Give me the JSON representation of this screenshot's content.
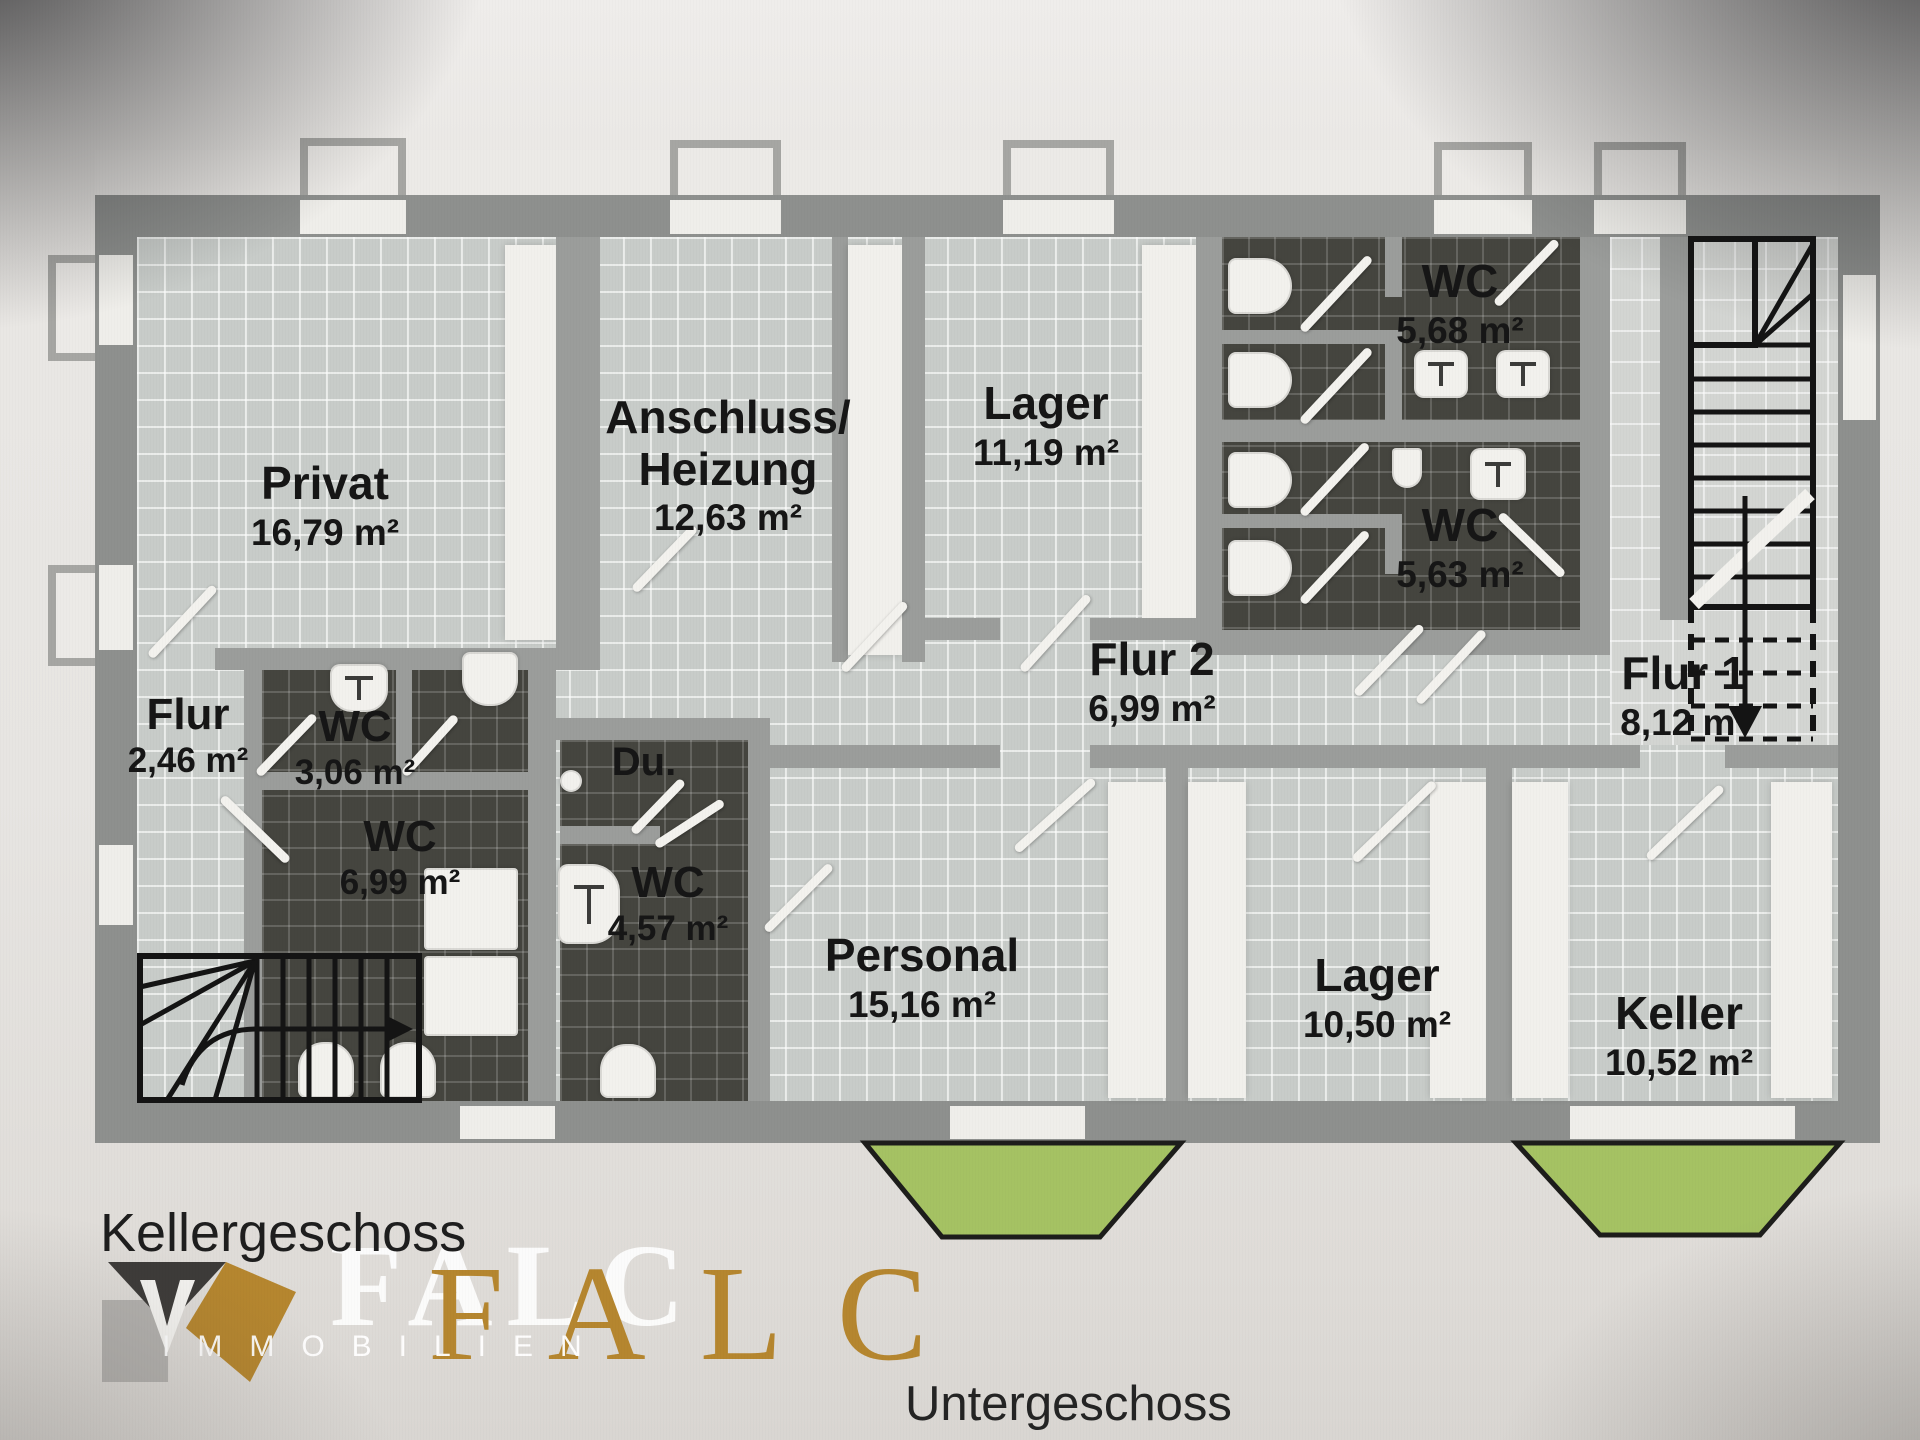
{
  "meta": {
    "floor_title": "Kellergeschoss",
    "caption": "Untergeschoss"
  },
  "logo": {
    "brand": "FALC",
    "brand_ghost": "FALC",
    "subtitle": "IMMOBILIEN",
    "gold_color": "#b5862f"
  },
  "colors": {
    "wall": "#8e908e",
    "light_tile": "#c8ccc9",
    "dark_tile": "#45453f",
    "lightwell_green": "#a5c263",
    "background": "#e7e5e2"
  },
  "rooms": {
    "privat": {
      "name": "Privat",
      "area": "16,79 m²"
    },
    "anschluss": {
      "name": "Anschluss/",
      "name2": "Heizung",
      "area": "12,63 m²"
    },
    "lager_top": {
      "name": "Lager",
      "area": "11,19 m²"
    },
    "wc_568": {
      "name": "WC",
      "area": "5,68 m²"
    },
    "wc_563": {
      "name": "WC",
      "area": "5,63 m²"
    },
    "flur2": {
      "name": "Flur 2",
      "area": "6,99 m²"
    },
    "flur1": {
      "name": "Flur 1",
      "area": "8,12 m²"
    },
    "flur": {
      "name": "Flur",
      "area": "2,46 m²"
    },
    "wc_306": {
      "name": "WC",
      "area": "3,06 m²"
    },
    "wc_699": {
      "name": "WC",
      "area": "6,99 m²"
    },
    "du": {
      "name": "Du.",
      "area": ""
    },
    "wc_457": {
      "name": "WC",
      "area": "4,57 m²"
    },
    "personal": {
      "name": "Personal",
      "area": "15,16 m²"
    },
    "lager_unten": {
      "name": "Lager",
      "area": "10,50 m²"
    },
    "keller": {
      "name": "Keller",
      "area": "10,52 m²"
    }
  }
}
